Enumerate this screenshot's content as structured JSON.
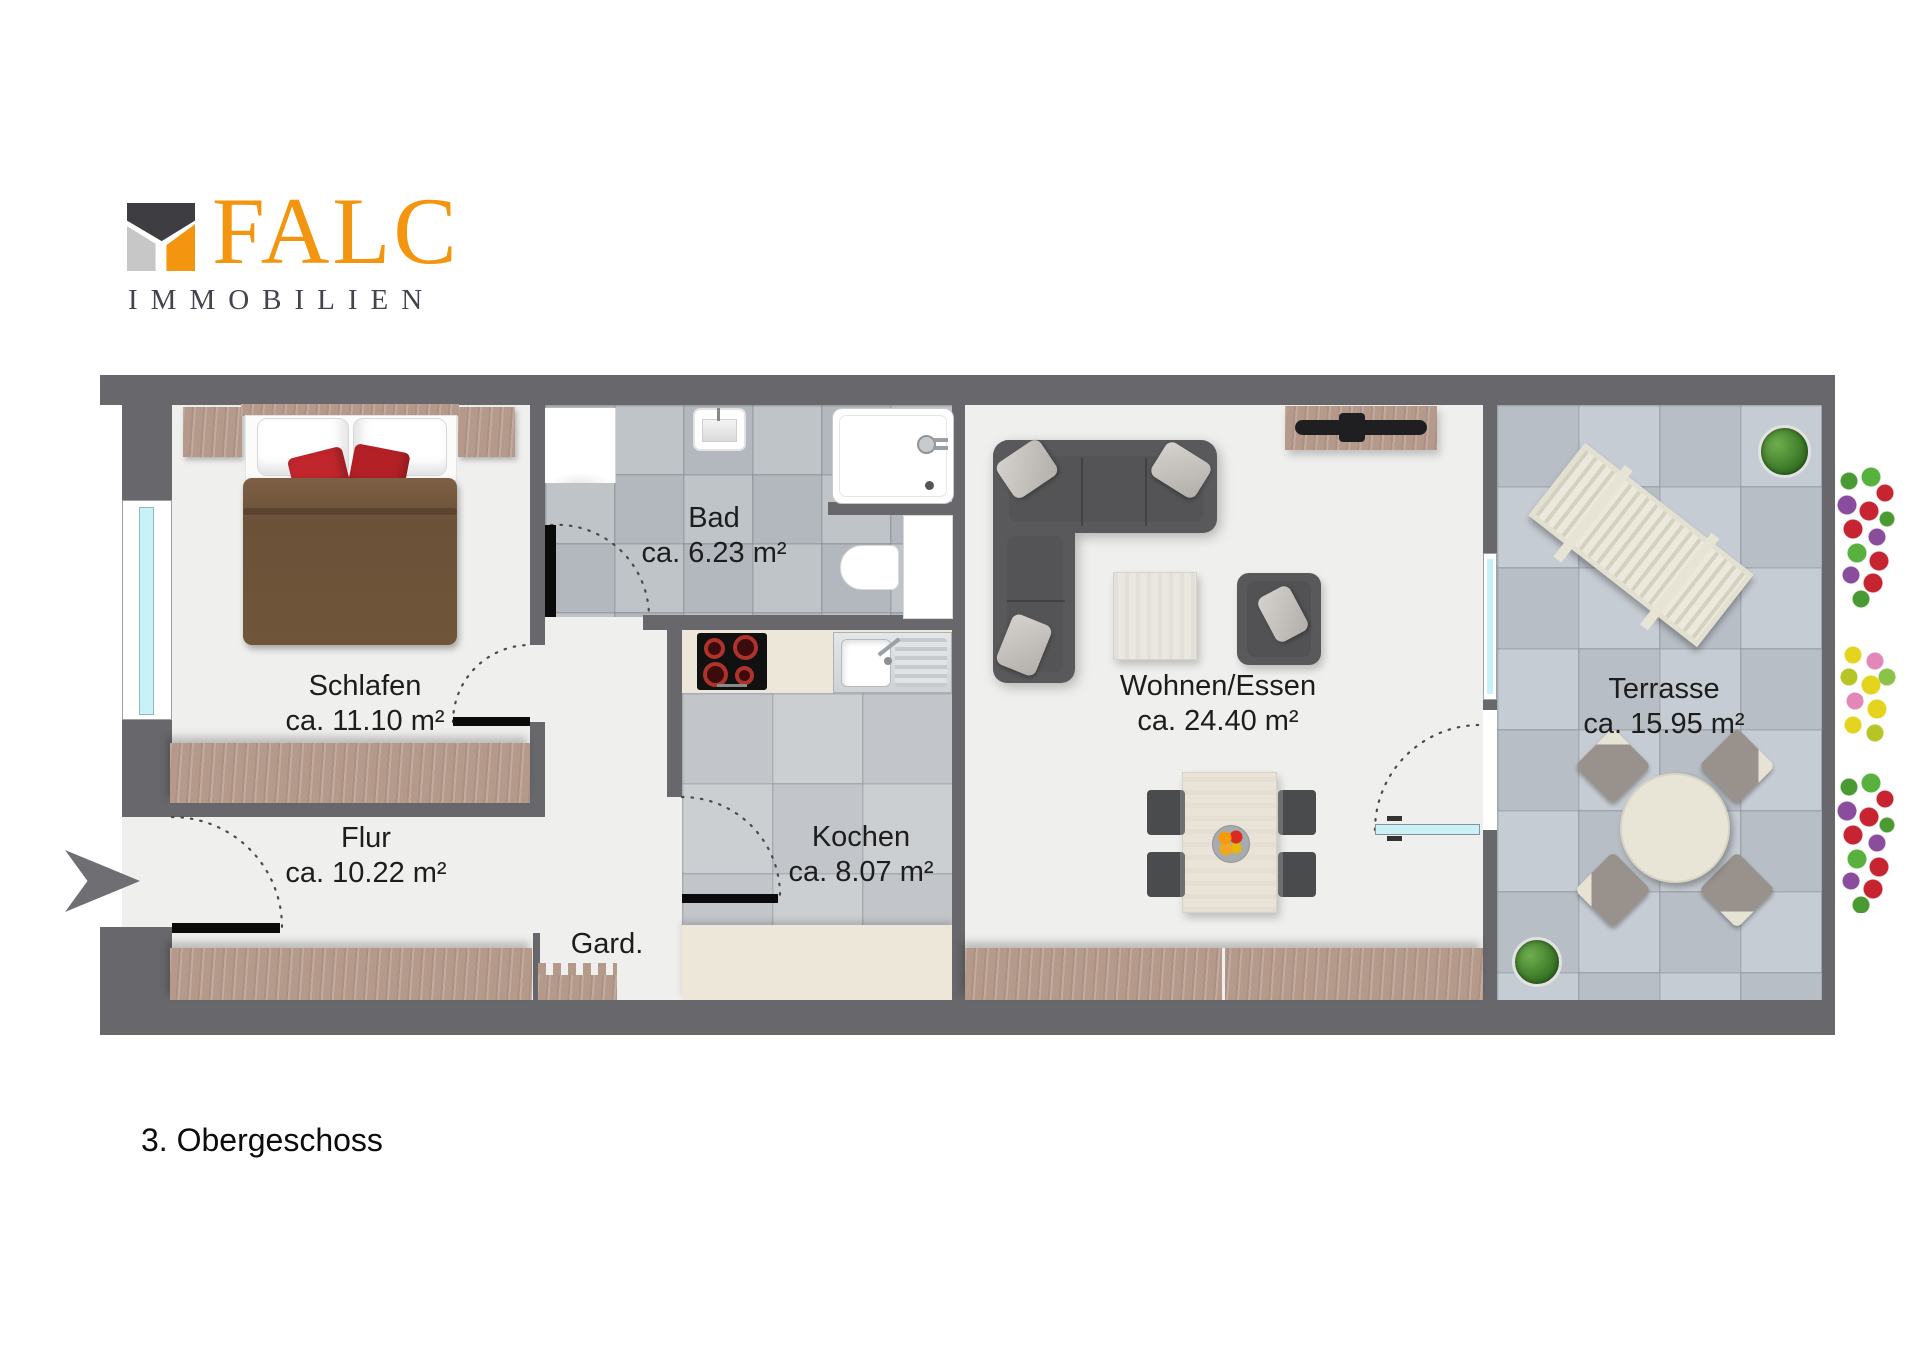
{
  "logo": {
    "brand": "FALC",
    "subtitle": "IMMOBILIEN"
  },
  "plan": {
    "rooms": [
      {
        "name": "Schlafen",
        "area": "ca. 11.10 m²"
      },
      {
        "name": "Bad",
        "area": "ca. 6.23 m²"
      },
      {
        "name": "Flur",
        "area": "ca. 10.22 m²"
      },
      {
        "name": "Kochen",
        "area": "ca. 8.07 m²"
      },
      {
        "name": "Gard.",
        "area": ""
      },
      {
        "name": "Wohnen/Essen",
        "area": "ca. 24.40 m²"
      },
      {
        "name": "Terrasse",
        "area": "ca. 15.95 m²"
      }
    ]
  },
  "floor_label": "3. Obergeschoss",
  "colors": {
    "wall": "#68686C",
    "logo_orange": "#F3950F",
    "logo_dark": "#3E3D41",
    "logo_gray": "#C7C7C7",
    "glass": "#C9F2F8",
    "wood": "#B59A8B",
    "floor": "#EFEFED",
    "tile_bad": "#B9BEC4",
    "tile_kitchen": "#C6CACD",
    "tile_terrace": "#BDC3CA",
    "accent_pillow_red": "#C0262C"
  }
}
